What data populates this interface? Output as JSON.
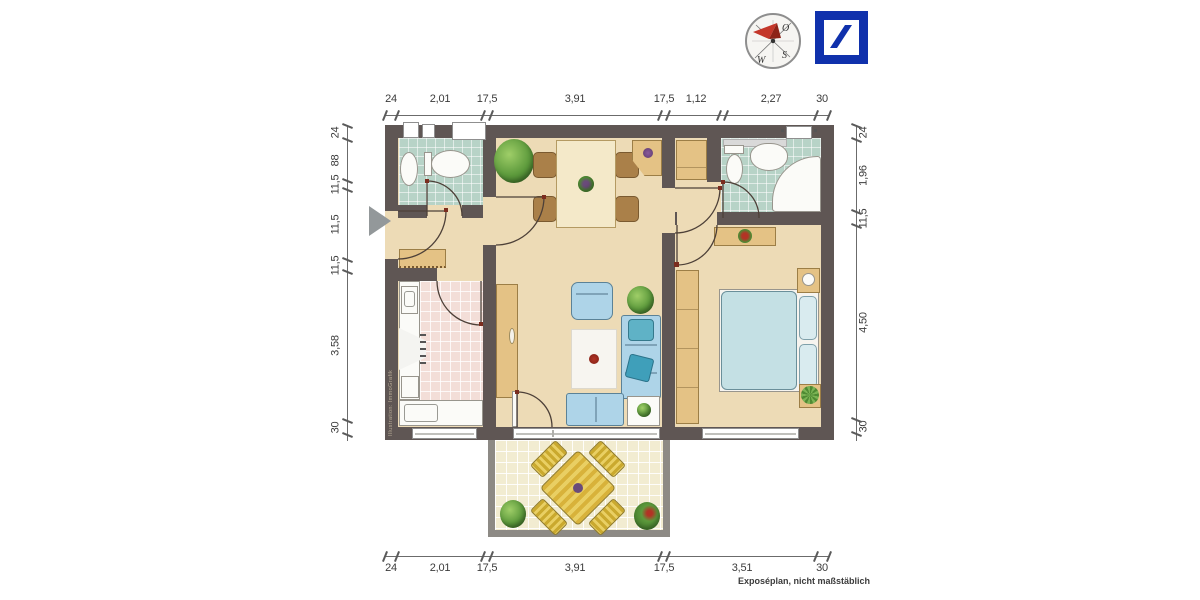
{
  "branding": {
    "compass": {
      "east": "O",
      "south": "S",
      "west": "W"
    },
    "logo": {
      "name": "deutsche-bank-logo"
    }
  },
  "dims": {
    "top": [
      "24",
      "2,01",
      "17,5",
      "3,91",
      "17,5",
      "1,12",
      "2,27",
      "30"
    ],
    "bottom": [
      "24",
      "2,01",
      "17,5",
      "3,91",
      "17,5",
      "3,51",
      "30"
    ],
    "left": [
      "24",
      "88",
      "11,5",
      "11,5",
      "11,5",
      "3,58",
      "30"
    ],
    "right": [
      "24",
      "1,96",
      "11,5",
      "4,50",
      "30"
    ]
  },
  "notes": {
    "disclaimer": "Exposéplan, nicht maßstäblich",
    "watermark": "Illustration: ImmoGrafik"
  },
  "colors": {
    "wall": "#5F5654",
    "floor": "#EDDBB6",
    "bathTile": "#B7D3C7",
    "kitchenTile": "#F3DED8",
    "balconyTile": "#F2ECD1",
    "wood": "#E4C285",
    "sofa": "#AED4E8",
    "logoBlue": "#1031AC",
    "compassRed": "#C4372A",
    "dimText": "#3B3B3B"
  }
}
